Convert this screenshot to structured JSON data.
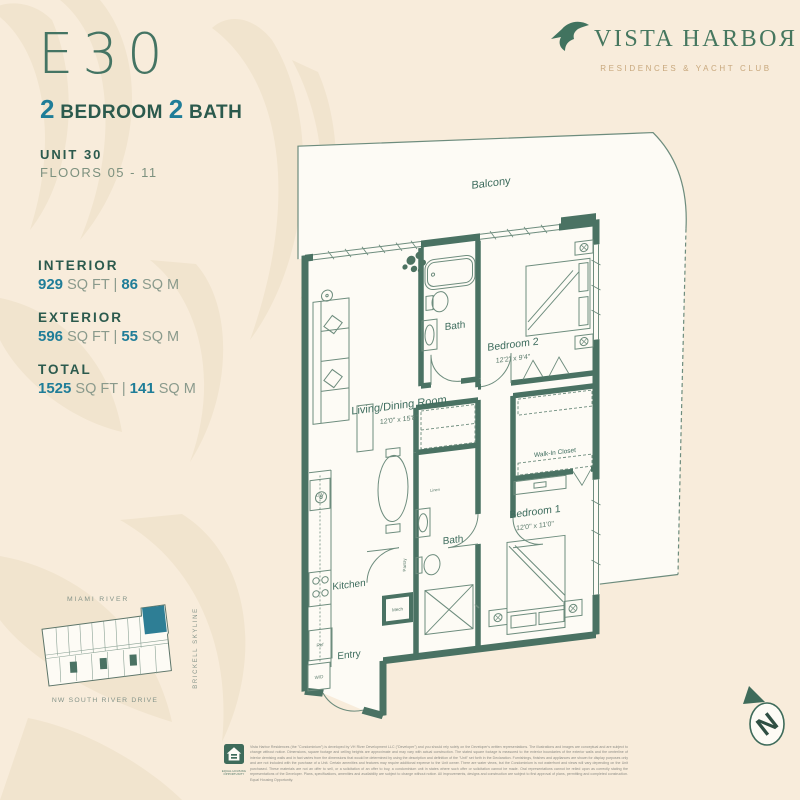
{
  "colors": {
    "bg": "#f8ecdb",
    "pattern": "#f1e4ce",
    "wall": "#4a7263",
    "line": "#6d8c7d",
    "accent": "#2e7e95",
    "heading": "#2b5a4d",
    "muted": "#7d917f",
    "gold": "#c8a87d",
    "plan_bg": "#fdfbf5",
    "footer_gray": "#8d8d86"
  },
  "brand": {
    "name": "VISTA HARBOЯ",
    "tagline": "RESIDENCES & YACHT CLUB"
  },
  "header": {
    "unit_code": "E30",
    "bed_count": "2",
    "bed_label": "BEDROOM",
    "bath_count": "2",
    "bath_label": "BATH",
    "unit_label": "UNIT 30",
    "floors_label": "FLOORS 05 - 11"
  },
  "stats": [
    {
      "label": "INTERIOR",
      "v1": "929",
      "u1": "SQ FT |",
      "v2": "86",
      "u2": "SQ M"
    },
    {
      "label": "EXTERIOR",
      "v1": "596",
      "u1": "SQ FT |",
      "v2": "55",
      "u2": "SQ M"
    },
    {
      "label": "TOTAL",
      "v1": "1525",
      "u1": "SQ FT |",
      "v2": "141",
      "u2": "SQ M"
    }
  ],
  "floorplan": {
    "balcony": "Balcony",
    "bath_upper": "Bath",
    "bath_lower": "Bath",
    "bedroom2": {
      "name": "Bedroom 2",
      "dims": "12'2\" x 9'4\""
    },
    "living": {
      "name": "Living/Dining Room",
      "dims": "12'0\" x 15'8\""
    },
    "closet": "Walk-In Closet",
    "bedroom1": {
      "name": "Bedroom 1",
      "dims": "12'0\" x 11'0\""
    },
    "kitchen": "Kitchen",
    "entry": "Entry",
    "fixtures": {
      "dw": "DW",
      "ref": "Ref",
      "wd": "W/D",
      "mech": "Mech",
      "pantry": "Pantry",
      "linen": "Linen"
    }
  },
  "keyplan": {
    "top": "MIAMI RIVER",
    "right": "BRICKELL SKYLINE",
    "bottom": "NW SOUTH RIVER DRIVE"
  },
  "compass": {
    "letter": "N"
  },
  "footer": {
    "eho": "EQUAL HOUSING OPPORTUNITY",
    "disclaimer": "Vista Harbor Residences (the \"Condominium\") is developed by VH River Development LLC (\"Developer\") and you should rely solely on the Developer's written representations. The illustrations and images are conceptual and are subject to change without notice. Dimensions, square footage and ceiling heights are approximate and may vary with actual construction. The stated square footage is measured to the exterior boundaries of the exterior walls and the centerline of interior demising walls and in fact varies from the dimensions that would be determined by using the description and definition of the \"Unit\" set forth in the Declaration. Furnishings, finishes and appliances are shown for display purposes only and are not included with the purchase of a Unit. Certain amenities and features may require additional expense to the Unit owner. There are water views, but the Condominium is not waterfront and views will vary depending on the Unit purchased. These materials are not an offer to sell, or a solicitation of an offer to buy, a condominium unit in states where such offer or solicitation cannot be made. Oral representations cannot be relied upon as correctly stating the representations of the Developer. Plans, specifications, amenities and availability are subject to change without notice. All improvements, designs and construction are subject to first approval of plans, permitting and completed construction. Equal Housing Opportunity."
  }
}
